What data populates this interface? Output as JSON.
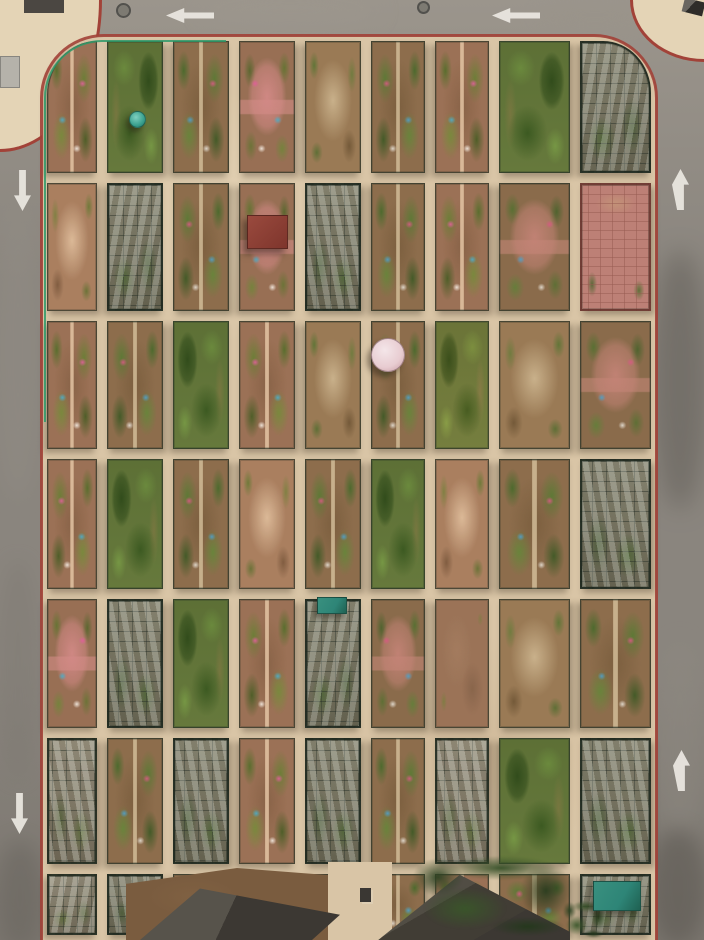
{
  "scene": {
    "description": "Aerial drone photograph of a rounded rectangular community-garden allotment block of caged plots, ringed by an asphalt road with painted white direction arrows and a red curb line",
    "width": 704,
    "height": 940
  },
  "palette": {
    "road": "#8a857e",
    "road_light": "#9b958c",
    "road_dark": "#5f5b55",
    "road_dark2": "#7b766f",
    "curb": "#a24238",
    "path": "#d9c5a6",
    "pavement": "#e4d4b6",
    "soil": "#8d6d4c",
    "leaf": "#5a7836",
    "leaf_bright": "#7da244",
    "frame": "#2c3729",
    "glass": "#ccd3ca",
    "fence": "#2f9a6a",
    "roof": "#3c3833",
    "tarp": "#2e8577",
    "umbrella": "#e8ccd1",
    "umbrella_teal": "#3aa08e",
    "arrow": "#ebe8e1",
    "dirt": "#7a5c3f",
    "tree": "#33502a"
  },
  "road": {
    "patches": [
      {
        "x": 200,
        "y": -6,
        "w": 180,
        "h": 34,
        "color": "#9d978e",
        "alpha": 0.5,
        "blur": 10
      },
      {
        "x": 535,
        "y": 2,
        "w": 120,
        "h": 26,
        "color": "#99938a",
        "alpha": 0.45,
        "blur": 9
      },
      {
        "x": -6,
        "y": 200,
        "w": 48,
        "h": 300,
        "color": "#938e86",
        "alpha": 0.4,
        "blur": 10
      },
      {
        "x": 652,
        "y": 250,
        "w": 56,
        "h": 260,
        "color": "#5f5b55",
        "alpha": 0.5,
        "blur": 12
      },
      {
        "x": 656,
        "y": 640,
        "w": 48,
        "h": 200,
        "color": "#8f8a82",
        "alpha": 0.4,
        "blur": 10
      },
      {
        "x": -4,
        "y": 840,
        "w": 48,
        "h": 110,
        "color": "#64605a",
        "alpha": 0.45,
        "blur": 10
      },
      {
        "x": 648,
        "y": 828,
        "w": 60,
        "h": 118,
        "color": "#57534d",
        "alpha": 0.5,
        "blur": 10
      },
      {
        "x": -4,
        "y": 560,
        "w": 44,
        "h": 220,
        "color": "#7d7871",
        "alpha": 0.4,
        "blur": 9
      }
    ],
    "markings": {
      "arrows": [
        {
          "direction": "left",
          "x": 166,
          "y": 8,
          "w": 48,
          "h": 15
        },
        {
          "direction": "left",
          "x": 492,
          "y": 8,
          "w": 48,
          "h": 15
        },
        {
          "direction": "down",
          "x": 14,
          "y": 170,
          "w": 17,
          "h": 41
        },
        {
          "direction": "up",
          "x": 672,
          "y": 169,
          "w": 17,
          "h": 41
        },
        {
          "direction": "up",
          "x": 673,
          "y": 750,
          "w": 17,
          "h": 41
        },
        {
          "direction": "down",
          "x": 11,
          "y": 793,
          "w": 17,
          "h": 41
        }
      ],
      "manholes": [
        {
          "x": 116,
          "y": 3,
          "d": 15
        },
        {
          "x": 417,
          "y": 1,
          "d": 13
        }
      ]
    }
  },
  "outer": {
    "pavement_top_left": {
      "x": 0,
      "y": 0,
      "w": 102,
      "h": 152
    },
    "pavement_top_right": {
      "x": 630,
      "y": 0,
      "w": 74,
      "h": 62
    },
    "building_fragment": {
      "x": 24,
      "y": 0,
      "w": 40,
      "h": 13
    },
    "utility_box": {
      "x": 0,
      "y": 56,
      "w": 20,
      "h": 32
    },
    "parked_car": {
      "x": 683,
      "y": 0,
      "w": 21,
      "h": 14
    }
  },
  "block": {
    "x": 42,
    "y": 36,
    "w": 614,
    "h": 904,
    "corner_radius": 62,
    "col_boundaries": [
      42,
      102,
      168,
      234,
      300,
      366,
      430,
      494,
      575,
      656
    ],
    "row_boundaries": [
      36,
      178,
      316,
      454,
      594,
      733,
      869,
      940
    ],
    "plot_inset": 5,
    "type_grid": [
      "babecbbad",
      "cdbedbbeg",
      "bbabcbace",
      "babcbacbd",
      "edabdefcb",
      "dbdbdbdad",
      "ddbbbbbbd"
    ],
    "fence": {
      "x": 44,
      "y": 40,
      "w": 182,
      "h": 382,
      "radius": 58
    }
  },
  "overlays": [
    {
      "kind": "umbrella-pink",
      "name": "garden-umbrella",
      "x": 371,
      "y": 338,
      "w": 34,
      "h": 34
    },
    {
      "kind": "umbrella-teal",
      "name": "garden-umbrella",
      "x": 129,
      "y": 111,
      "w": 17,
      "h": 17
    },
    {
      "kind": "redroof",
      "name": "shed-red-roof",
      "x": 247,
      "y": 215,
      "w": 41,
      "h": 34
    },
    {
      "kind": "tarp",
      "name": "tarp-cover",
      "x": 317,
      "y": 597,
      "w": 30,
      "h": 17
    },
    {
      "kind": "dirt",
      "name": "dirt-patch",
      "x": 126,
      "y": 868,
      "w": 222,
      "h": 72
    },
    {
      "kind": "path",
      "name": "path-strip",
      "x": 328,
      "y": 862,
      "w": 64,
      "h": 78
    },
    {
      "kind": "roof",
      "name": "building-roof",
      "x": 140,
      "y": 884,
      "w": 200,
      "h": 56
    },
    {
      "kind": "roofhip",
      "name": "building-roof-hip",
      "x": 366,
      "y": 872,
      "w": 204,
      "h": 68
    },
    {
      "kind": "chimney",
      "name": "chimney",
      "x": 360,
      "y": 888,
      "w": 11,
      "h": 14
    },
    {
      "kind": "trees",
      "name": "tree-canopy",
      "x": 402,
      "y": 850,
      "w": 180,
      "h": 90
    },
    {
      "kind": "trees",
      "name": "tree-canopy",
      "x": 560,
      "y": 898,
      "w": 48,
      "h": 42
    },
    {
      "kind": "tarp",
      "name": "tarp-cover",
      "x": 593,
      "y": 881,
      "w": 48,
      "h": 30
    }
  ]
}
